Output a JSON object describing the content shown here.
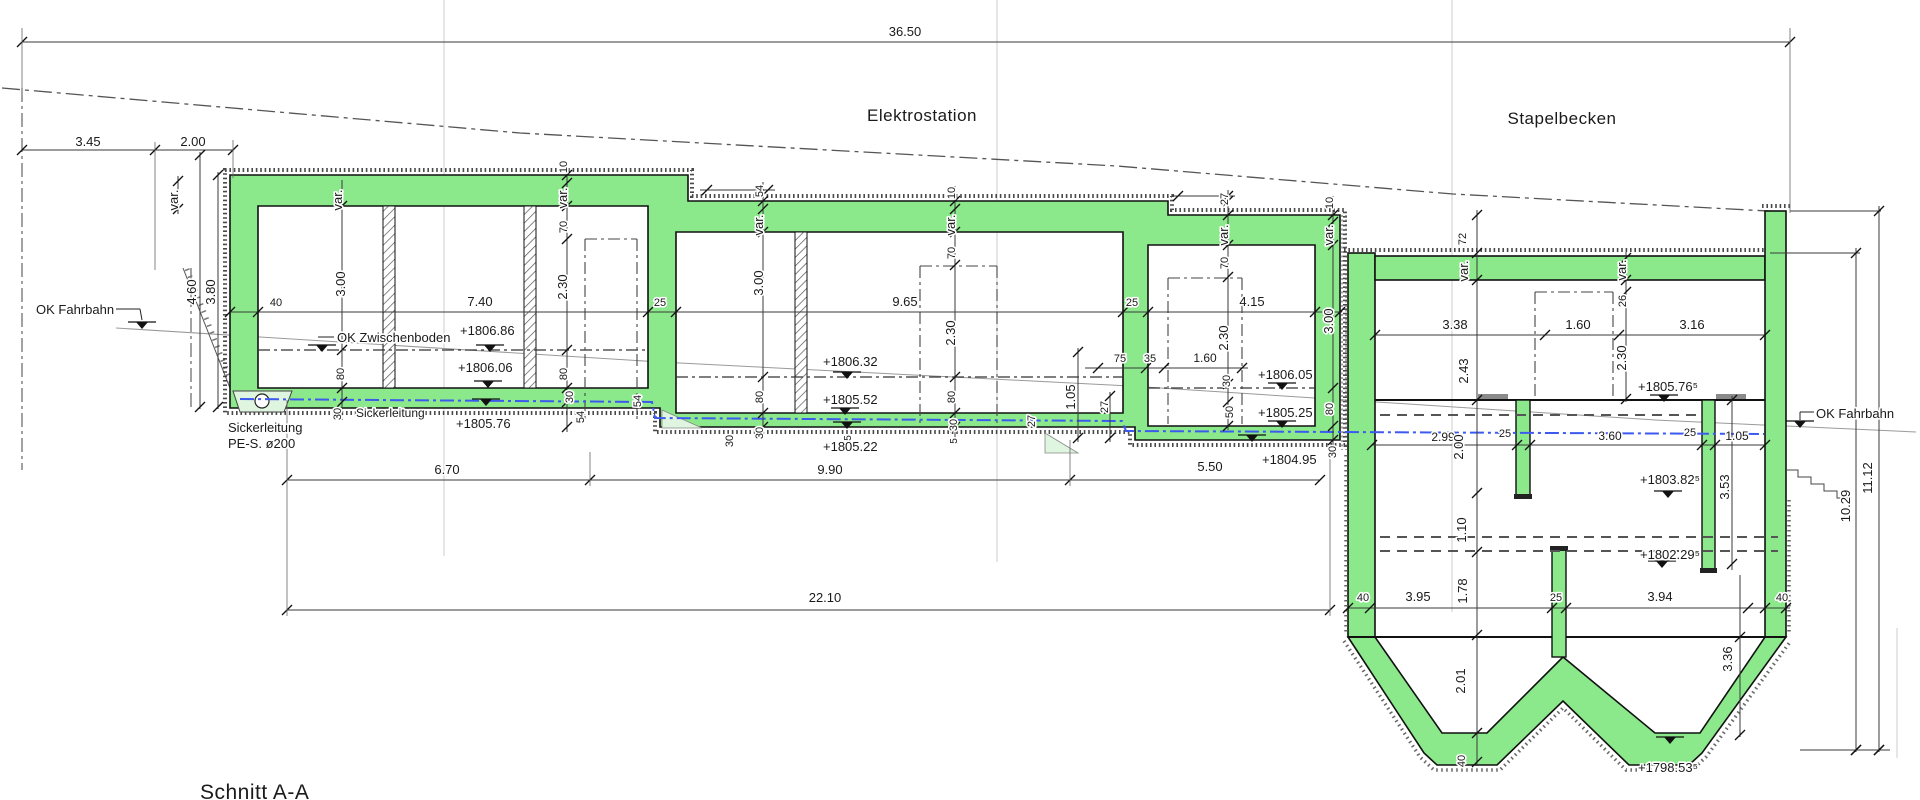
{
  "drawing": {
    "section_title": "Schnitt A-A",
    "area_left": "Elektrostation",
    "area_right": "Stapelbecken"
  },
  "colors": {
    "concrete_green": "#8BE88B",
    "light_green": "#DFF5DF",
    "pipe_blue": "#3D5AF0",
    "line_dark": "#1a1a1a",
    "dim_gray": "#3a3a3a",
    "grid_gray": "#cccccc"
  },
  "symbols": {
    "level_marker": "filled triangle with bar (elevation mark)",
    "level_marker_positions": [
      [
        142,
        329
      ],
      [
        322,
        352
      ],
      [
        490,
        352
      ],
      [
        488,
        388
      ],
      [
        486,
        406
      ],
      [
        847,
        379
      ],
      [
        845,
        415
      ],
      [
        847,
        429
      ],
      [
        1282,
        390
      ],
      [
        1282,
        428
      ],
      [
        1252,
        442
      ],
      [
        1664,
        402
      ],
      [
        1668,
        498
      ],
      [
        1662,
        568
      ],
      [
        1670,
        744
      ],
      [
        1800,
        428
      ]
    ]
  },
  "labels": [
    {
      "t": "36.50",
      "x": 905,
      "y": 36
    },
    {
      "t": "3.45",
      "x": 88,
      "y": 146
    },
    {
      "t": "2.00",
      "x": 193,
      "y": 146
    },
    {
      "t": "40",
      "x": 276,
      "y": 306,
      "s": 11
    },
    {
      "t": "7.40",
      "x": 480,
      "y": 306
    },
    {
      "t": "25",
      "x": 660,
      "y": 306,
      "s": 11
    },
    {
      "t": "9.65",
      "x": 905,
      "y": 306
    },
    {
      "t": "25",
      "x": 1132,
      "y": 306,
      "s": 11
    },
    {
      "t": "4.15",
      "x": 1252,
      "y": 306
    },
    {
      "t": "75",
      "x": 1120,
      "y": 362,
      "s": 11
    },
    {
      "t": "35",
      "x": 1150,
      "y": 362,
      "s": 11
    },
    {
      "t": "1.60",
      "x": 1205,
      "y": 362,
      "s": 12
    },
    {
      "t": "3.38",
      "x": 1455,
      "y": 329
    },
    {
      "t": "1.60",
      "x": 1578,
      "y": 329
    },
    {
      "t": "3.16",
      "x": 1692,
      "y": 329
    },
    {
      "t": "2.99",
      "x": 1443,
      "y": 441,
      "s": 12
    },
    {
      "t": "25",
      "x": 1505,
      "y": 437,
      "s": 11
    },
    {
      "t": "3.60",
      "x": 1610,
      "y": 440,
      "s": 12
    },
    {
      "t": "25",
      "x": 1690,
      "y": 436,
      "s": 11
    },
    {
      "t": "1.05",
      "x": 1737,
      "y": 440,
      "s": 12
    },
    {
      "t": "6.70",
      "x": 447,
      "y": 474
    },
    {
      "t": "9.90",
      "x": 830,
      "y": 474
    },
    {
      "t": "5.50",
      "x": 1210,
      "y": 471
    },
    {
      "t": "22.10",
      "x": 825,
      "y": 602
    },
    {
      "t": "40",
      "x": 1363,
      "y": 601,
      "s": 11
    },
    {
      "t": "3.95",
      "x": 1418,
      "y": 601
    },
    {
      "t": "25",
      "x": 1556,
      "y": 601,
      "s": 11
    },
    {
      "t": "3.94",
      "x": 1660,
      "y": 601
    },
    {
      "t": "40",
      "x": 1782,
      "y": 601,
      "s": 11
    },
    {
      "t": "var.",
      "x": 178,
      "y": 200,
      "r": 1
    },
    {
      "t": "4.60",
      "x": 196,
      "y": 292,
      "r": 1
    },
    {
      "t": "3.80",
      "x": 215,
      "y": 292,
      "r": 1
    },
    {
      "t": "var.",
      "x": 342,
      "y": 200,
      "r": 1
    },
    {
      "t": "3.00",
      "x": 345,
      "y": 284,
      "r": 1
    },
    {
      "t": "80",
      "x": 344,
      "y": 374,
      "r": 1,
      "s": 11
    },
    {
      "t": "30",
      "x": 341,
      "y": 414,
      "r": 1,
      "s": 11
    },
    {
      "t": "10",
      "x": 567,
      "y": 167,
      "r": 1,
      "s": 11
    },
    {
      "t": "var.",
      "x": 567,
      "y": 198,
      "r": 1
    },
    {
      "t": "70",
      "x": 567,
      "y": 227,
      "r": 1,
      "s": 11
    },
    {
      "t": "2.30",
      "x": 567,
      "y": 287,
      "r": 1
    },
    {
      "t": "80",
      "x": 567,
      "y": 374,
      "r": 1,
      "s": 11
    },
    {
      "t": "30",
      "x": 573,
      "y": 397,
      "r": 1,
      "s": 11
    },
    {
      "t": "54",
      "x": 584,
      "y": 417,
      "r": 1,
      "s": 11
    },
    {
      "t": "54",
      "x": 641,
      "y": 401,
      "r": 1,
      "s": 11
    },
    {
      "t": "54",
      "x": 763,
      "y": 191,
      "r": 1,
      "s": 11
    },
    {
      "t": "var.",
      "x": 763,
      "y": 225,
      "r": 1
    },
    {
      "t": "3.00",
      "x": 763,
      "y": 283,
      "r": 1
    },
    {
      "t": "80",
      "x": 763,
      "y": 397,
      "r": 1,
      "s": 11
    },
    {
      "t": "30",
      "x": 763,
      "y": 433,
      "r": 1,
      "s": 11
    },
    {
      "t": "10",
      "x": 955,
      "y": 193,
      "r": 1,
      "s": 11
    },
    {
      "t": "var.",
      "x": 955,
      "y": 225,
      "r": 1
    },
    {
      "t": "70",
      "x": 955,
      "y": 253,
      "r": 1,
      "s": 11
    },
    {
      "t": "2.30",
      "x": 955,
      "y": 333,
      "r": 1
    },
    {
      "t": "80",
      "x": 955,
      "y": 397,
      "r": 1,
      "s": 11
    },
    {
      "t": "30",
      "x": 957,
      "y": 425,
      "r": 1,
      "s": 11
    },
    {
      "t": "5",
      "x": 851,
      "y": 438,
      "r": 1,
      "s": 10
    },
    {
      "t": "5",
      "x": 957,
      "y": 441,
      "r": 1,
      "s": 10
    },
    {
      "t": "30",
      "x": 733,
      "y": 441,
      "r": 1,
      "s": 11
    },
    {
      "t": "27",
      "x": 1035,
      "y": 421,
      "r": 1,
      "s": 11
    },
    {
      "t": "1.05",
      "x": 1075,
      "y": 397,
      "r": 1
    },
    {
      "t": "27",
      "x": 1108,
      "y": 407,
      "r": 1,
      "s": 11
    },
    {
      "t": "27",
      "x": 1228,
      "y": 199,
      "r": 1,
      "s": 11
    },
    {
      "t": "var.",
      "x": 1228,
      "y": 235,
      "r": 1
    },
    {
      "t": "70",
      "x": 1228,
      "y": 263,
      "r": 1,
      "s": 11
    },
    {
      "t": "2.30",
      "x": 1228,
      "y": 338,
      "r": 1
    },
    {
      "t": "30",
      "x": 1230,
      "y": 381,
      "r": 1,
      "s": 11
    },
    {
      "t": "50",
      "x": 1233,
      "y": 412,
      "r": 1,
      "s": 11
    },
    {
      "t": "10",
      "x": 1333,
      "y": 203,
      "r": 1,
      "s": 11
    },
    {
      "t": "var.",
      "x": 1333,
      "y": 235,
      "r": 1
    },
    {
      "t": "3.00",
      "x": 1333,
      "y": 321,
      "r": 1
    },
    {
      "t": "80",
      "x": 1333,
      "y": 409,
      "r": 1,
      "s": 11
    },
    {
      "t": "30",
      "x": 1336,
      "y": 452,
      "r": 1,
      "s": 11
    },
    {
      "t": "72",
      "x": 1466,
      "y": 239,
      "r": 1,
      "s": 11
    },
    {
      "t": "var.",
      "x": 1468,
      "y": 271,
      "r": 1
    },
    {
      "t": "2.43",
      "x": 1468,
      "y": 371,
      "r": 1
    },
    {
      "t": "2.00",
      "x": 1463,
      "y": 447,
      "r": 1
    },
    {
      "t": "1.10",
      "x": 1466,
      "y": 530,
      "r": 1
    },
    {
      "t": "1.78",
      "x": 1467,
      "y": 591,
      "r": 1
    },
    {
      "t": "2.01",
      "x": 1465,
      "y": 681,
      "r": 1
    },
    {
      "t": "40",
      "x": 1465,
      "y": 761,
      "r": 1,
      "s": 11
    },
    {
      "t": "var.",
      "x": 1626,
      "y": 270,
      "r": 1
    },
    {
      "t": "26",
      "x": 1626,
      "y": 301,
      "r": 1,
      "s": 11
    },
    {
      "t": "2.30",
      "x": 1626,
      "y": 358,
      "r": 1
    },
    {
      "t": "3.53",
      "x": 1729,
      "y": 487,
      "r": 1
    },
    {
      "t": "3.36",
      "x": 1732,
      "y": 659,
      "r": 1
    },
    {
      "t": "10.29",
      "x": 1850,
      "y": 506,
      "r": 1
    },
    {
      "t": "11.12",
      "x": 1872,
      "y": 478,
      "r": 1
    },
    {
      "t": "+1806.86",
      "x": 460,
      "y": 335,
      "a": "s"
    },
    {
      "t": "+1806.06",
      "x": 458,
      "y": 372,
      "a": "s"
    },
    {
      "t": "+1805.76",
      "x": 456,
      "y": 428,
      "a": "s"
    },
    {
      "t": "+1806.32",
      "x": 823,
      "y": 366,
      "a": "s"
    },
    {
      "t": "+1805.52",
      "x": 823,
      "y": 404,
      "a": "s"
    },
    {
      "t": "+1805.22",
      "x": 823,
      "y": 451,
      "a": "s"
    },
    {
      "t": "+1806.05",
      "x": 1258,
      "y": 379,
      "a": "s"
    },
    {
      "t": "+1805.25",
      "x": 1258,
      "y": 417,
      "a": "s"
    },
    {
      "t": "+1804.95",
      "x": 1262,
      "y": 464,
      "a": "s"
    },
    {
      "t": "+1805.76⁵",
      "x": 1638,
      "y": 391,
      "a": "s"
    },
    {
      "t": "+1803.82⁵",
      "x": 1640,
      "y": 484,
      "a": "s"
    },
    {
      "t": "+1802.29⁵",
      "x": 1640,
      "y": 559,
      "a": "s"
    },
    {
      "t": "+1798.53⁵",
      "x": 1638,
      "y": 772,
      "a": "s"
    },
    {
      "t": "OK Zwischenboden",
      "x": 337,
      "y": 342,
      "a": "s"
    },
    {
      "t": "OK Fahrbahn",
      "x": 36,
      "y": 314,
      "a": "s"
    },
    {
      "t": "OK Fahrbahn",
      "x": 1816,
      "y": 418,
      "a": "s"
    },
    {
      "t": "Sickerleitung",
      "x": 356,
      "y": 417,
      "a": "s",
      "c": "blue",
      "s": 12
    },
    {
      "t": "Sickerleitung",
      "x": 228,
      "y": 432,
      "a": "s"
    },
    {
      "t": "PE-S. ø200",
      "x": 228,
      "y": 448,
      "a": "s"
    }
  ]
}
